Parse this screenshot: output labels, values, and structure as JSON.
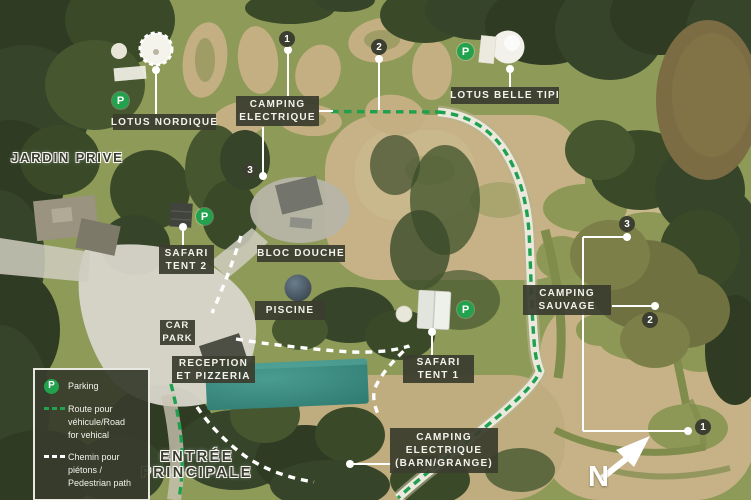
{
  "labels": {
    "lotus_nordique": "LOTUS NORDIQUE",
    "camping_electrique_l1": "CAMPING",
    "camping_electrique_l2": "ELECTRIQUE",
    "lotus_belle_tipi": "LOTUS BELLE TIPI",
    "jardin_prive": "JARDIN PRIVE",
    "safari_tent_2_l1": "SAFARI",
    "safari_tent_2_l2": "TENT 2",
    "bloc_douche": "BLOC DOUCHE",
    "piscine": "PISCINE",
    "car_park_l1": "CAR",
    "car_park_l2": "PARK",
    "reception_l1": "RECEPTION",
    "reception_l2": "ET PIZZERIA",
    "safari_tent_1_l1": "SAFARI",
    "safari_tent_1_l2": "TENT 1",
    "camping_sauvage_l1": "CAMPING",
    "camping_sauvage_l2": "SAUVAGE",
    "camping_barn_l1": "CAMPING",
    "camping_barn_l2": "ELECTRIQUE",
    "camping_barn_l3": "(BARN/GRANGE)",
    "entree_l1": "ENTRÉE",
    "entree_l2": "PRINCIPALE"
  },
  "markers": {
    "pitch_1": "1",
    "pitch_2": "2",
    "pitch_3": "3",
    "parking": "P"
  },
  "legend": {
    "parking_label": "Parking",
    "route_l1": "Route pour",
    "route_l2": "véhicule/Road",
    "route_l3": "for vehical",
    "path_l1": "Chemin pour",
    "path_l2": "piétons /",
    "path_l3": "Pedestrian path"
  },
  "compass": {
    "north": "N"
  },
  "colors": {
    "accent_green": "#23a24d",
    "label_box": "#3c3e30",
    "pool_teal": "#3a8c82",
    "route_dash_green": "#1ea04e",
    "pedestrian_dash": "#ffffff"
  }
}
